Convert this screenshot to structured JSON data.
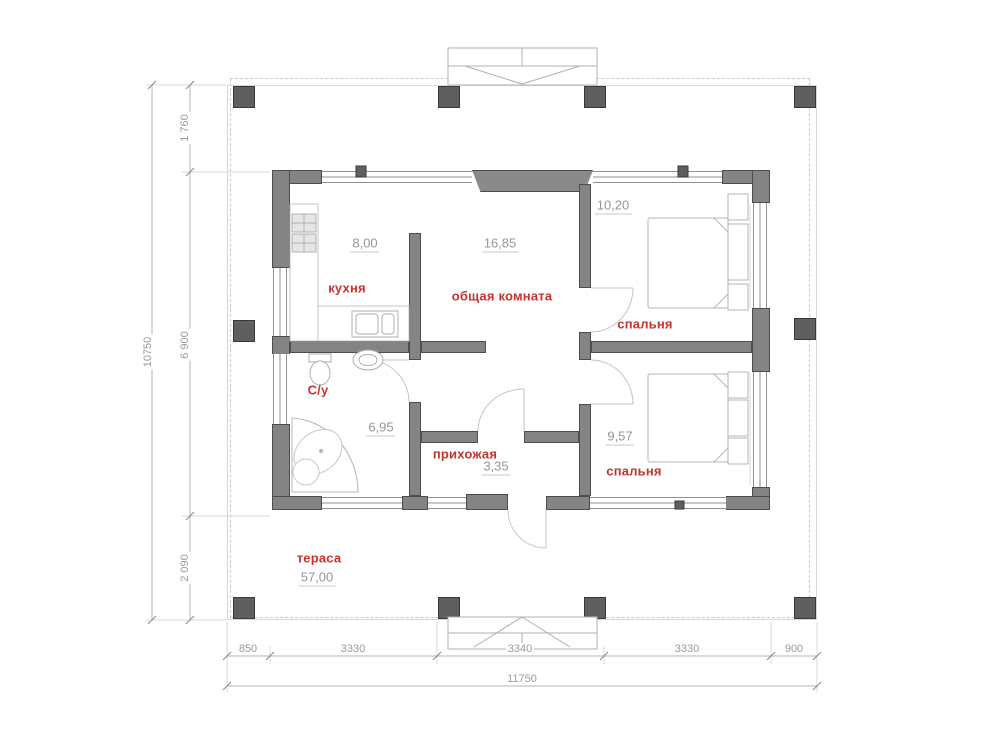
{
  "plan": {
    "rooms": {
      "kitchen": {
        "label": "кухня",
        "area": "8,00"
      },
      "living": {
        "label": "общая комната",
        "area": "16,85"
      },
      "bedroom1": {
        "label": "спальня",
        "area": "10,20"
      },
      "bedroom2": {
        "label": "спальня",
        "area": "9,57"
      },
      "bathroom": {
        "label": "С/у",
        "area": "6,95"
      },
      "hallway": {
        "label": "прихожая",
        "area": "3,35"
      },
      "terrace": {
        "label": "тераса",
        "area": "57,00"
      }
    },
    "dimensions": {
      "vertical_total": "10750",
      "vertical_chain": [
        "1 760",
        "6 900",
        "2 090"
      ],
      "horizontal_chain": [
        "850",
        "3330",
        "3340",
        "3330",
        "900"
      ],
      "horizontal_total": "11750"
    },
    "colors": {
      "wall": "#848484",
      "column": "#5f5f5f",
      "room_label": "#c5342c",
      "dimension_text": "#9a9a9a"
    }
  }
}
